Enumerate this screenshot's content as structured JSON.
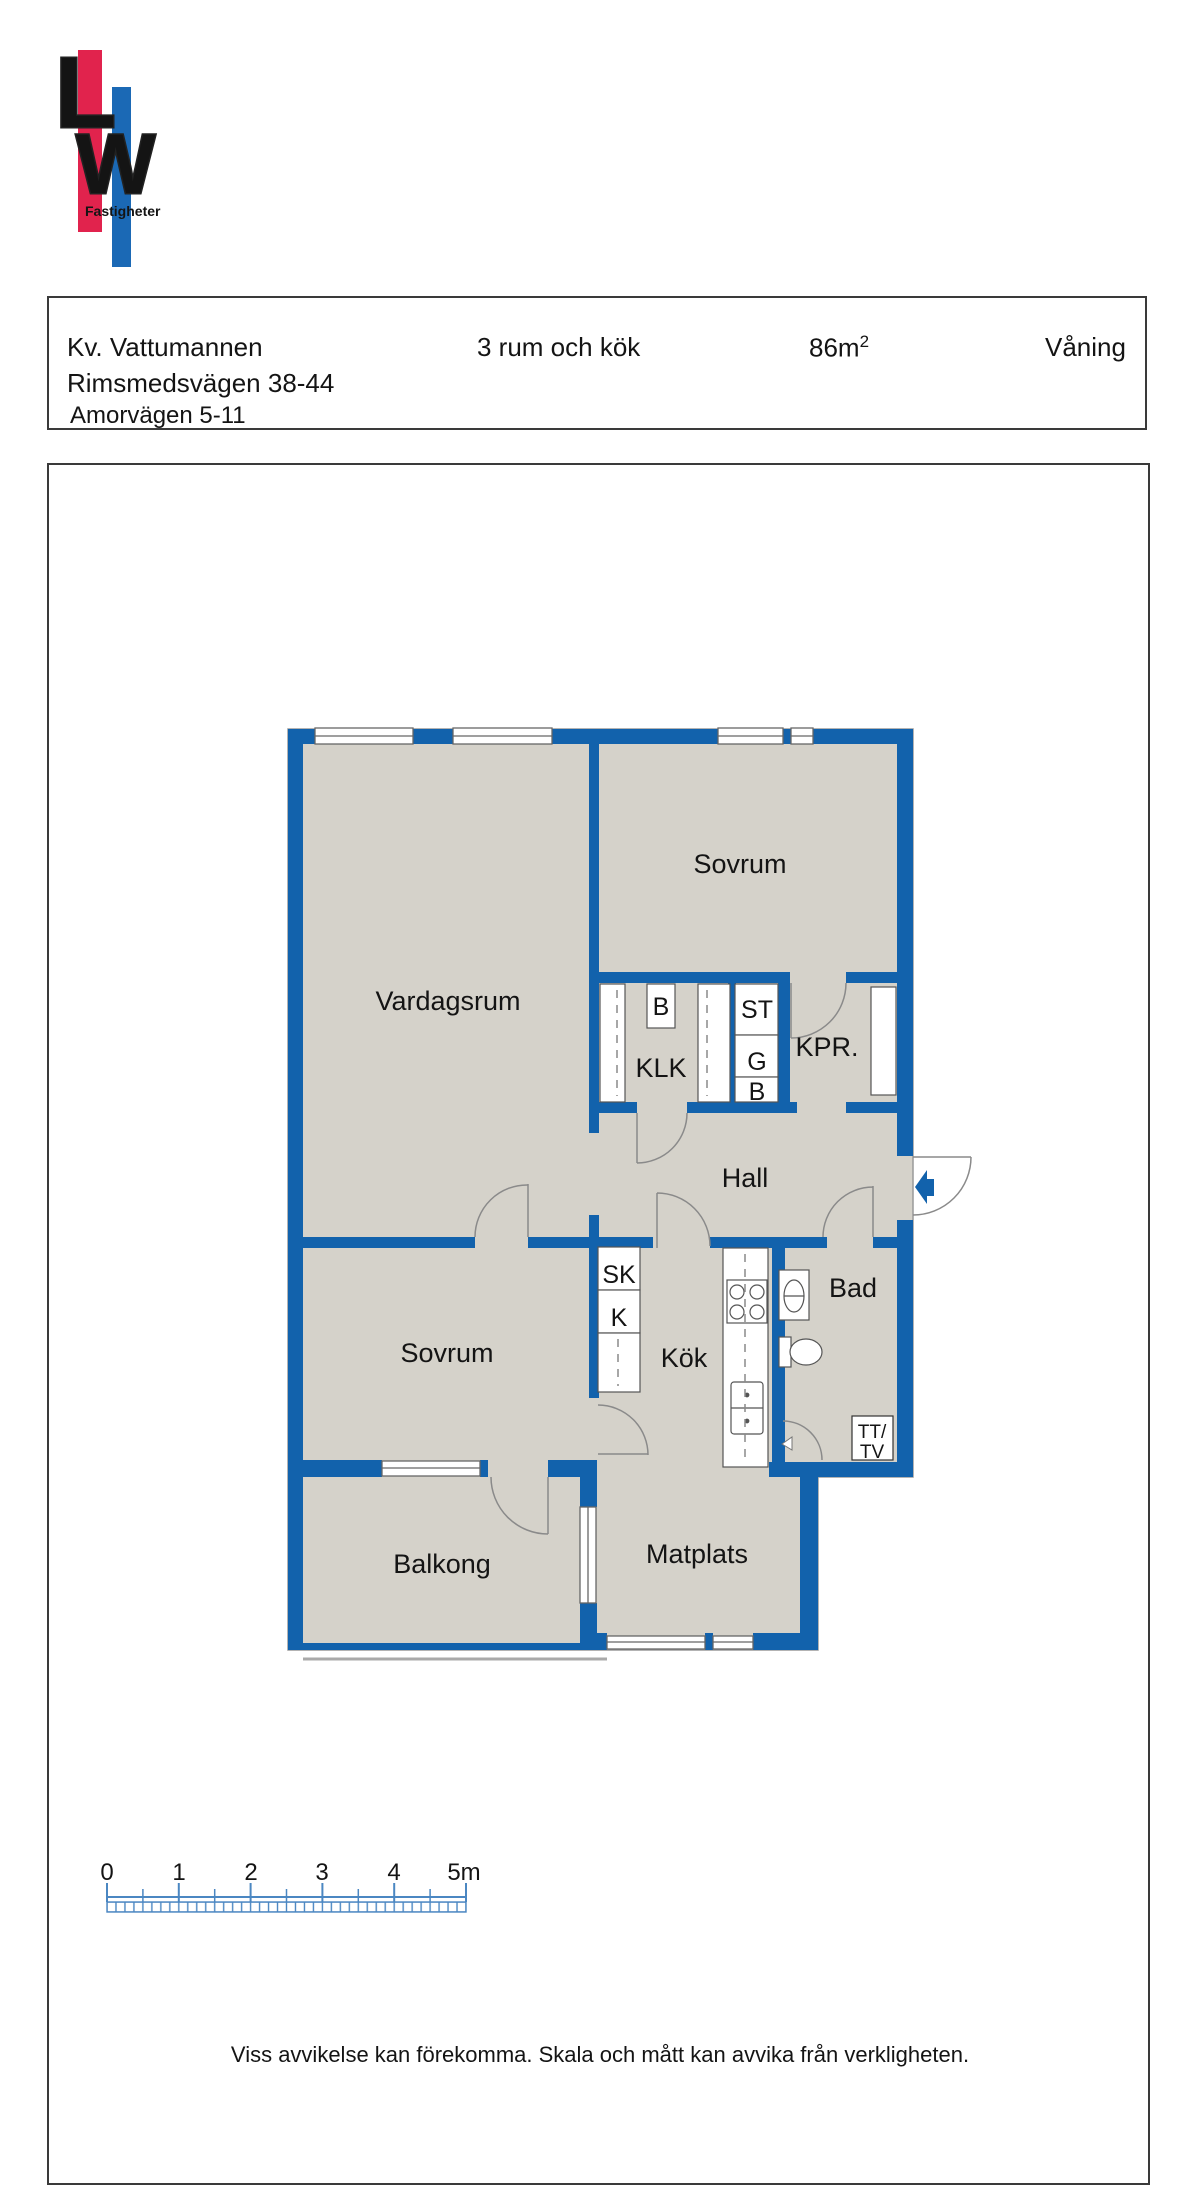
{
  "logo": {
    "l": "L",
    "w": "W",
    "subtitle": "Fastigheter"
  },
  "header": {
    "project": "Kv. Vattumannen",
    "address1": "Rimsmedsvägen 38-44",
    "address2": "Amorvägen 5-11",
    "rooms": "3 rum och kök",
    "area": "86m",
    "area_sup": "2",
    "floor": "Våning"
  },
  "plan": {
    "rooms": {
      "vardagsrum": "Vardagsrum",
      "sovrum1": "Sovrum",
      "sovrum2": "Sovrum",
      "klk": "KLK",
      "kpr": "KPR.",
      "hall": "Hall",
      "kok": "Kök",
      "bad": "Bad",
      "balkong": "Balkong",
      "matplats": "Matplats"
    },
    "closets": {
      "b1": "B",
      "st": "ST",
      "g": "G",
      "b2": "B",
      "sk": "SK",
      "k": "K",
      "tt": "TT/",
      "tv": "TV"
    }
  },
  "scale_bar": {
    "ticks": [
      "0",
      "1",
      "2",
      "3",
      "4",
      "5m"
    ]
  },
  "footer": {
    "disclaimer": "Viss avvikelse kan förekomma. Skala och mått kan avvika från verkligheten."
  },
  "colors": {
    "wall_blue": "#1262ac",
    "room_gray": "#d5d2ca",
    "scale_blue": "#4b87c2",
    "logo_red": "#e1234d",
    "logo_blue": "#1b69b5",
    "outline_gray": "#9a9a9a"
  }
}
